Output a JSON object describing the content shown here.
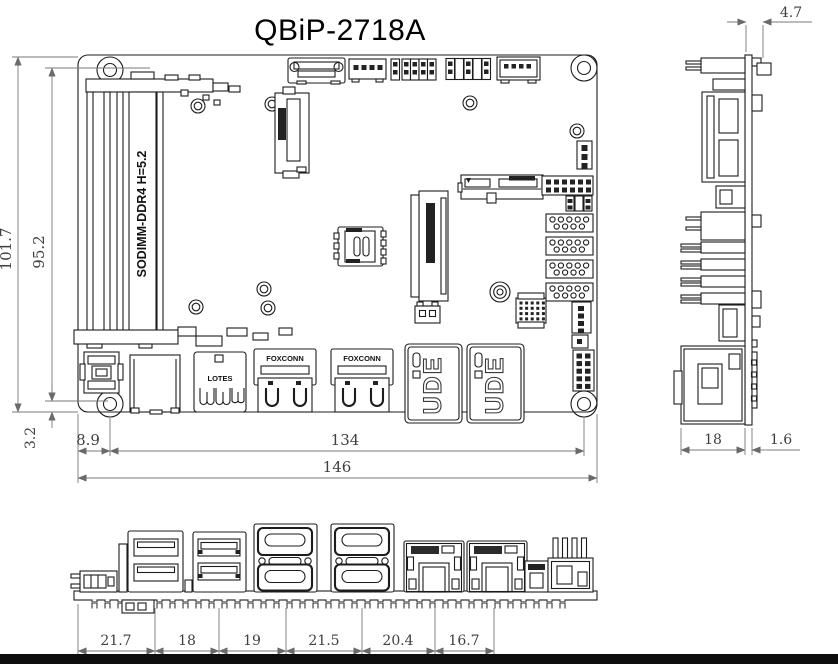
{
  "title": "QBiP-2718A",
  "colors": {
    "line": "#1c1c1c",
    "dimension_line": "#787878",
    "dimension_text": "#3f3f3f",
    "bottom_bar": "#0e0e0e",
    "background": "#ffffff"
  },
  "top_view": {
    "board_label": "SODIMM-DDR4 H=5.2",
    "hdmi_brand": "FOXCONN",
    "lan_brand": "UDE",
    "usb_brand": "LOTES",
    "dims": {
      "overall_height": "101.7",
      "mount_span_v": "95.2",
      "mount_offset_v": "3.2",
      "mount_offset_h": "8.9",
      "mount_span_h": "134",
      "overall_width": "146"
    }
  },
  "side_view": {
    "dims": {
      "rear_protrusion": "4.7",
      "connector_depth": "18",
      "pcb_thickness": "1.6"
    }
  },
  "front_view": {
    "dims": {
      "segments": [
        "21.7",
        "18",
        "19",
        "21.5",
        "20.4",
        "16.7"
      ]
    }
  }
}
